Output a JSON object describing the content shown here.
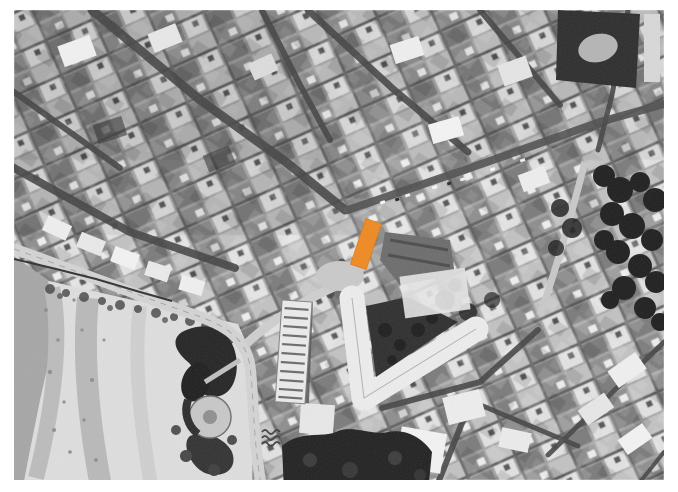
{
  "page": {
    "background": "#ffffff"
  },
  "map": {
    "kind": "grayscale aerial photograph of a coastal town with a sandy beach at lower left",
    "highlight_parcel": {
      "label": "highlighted-parcel",
      "fill": "#F0891F",
      "stroke": "#DD7911",
      "points": "366,219 381,224 366,269 351,264"
    },
    "wave_marker": {
      "stroke": "#3f3f3f"
    }
  }
}
